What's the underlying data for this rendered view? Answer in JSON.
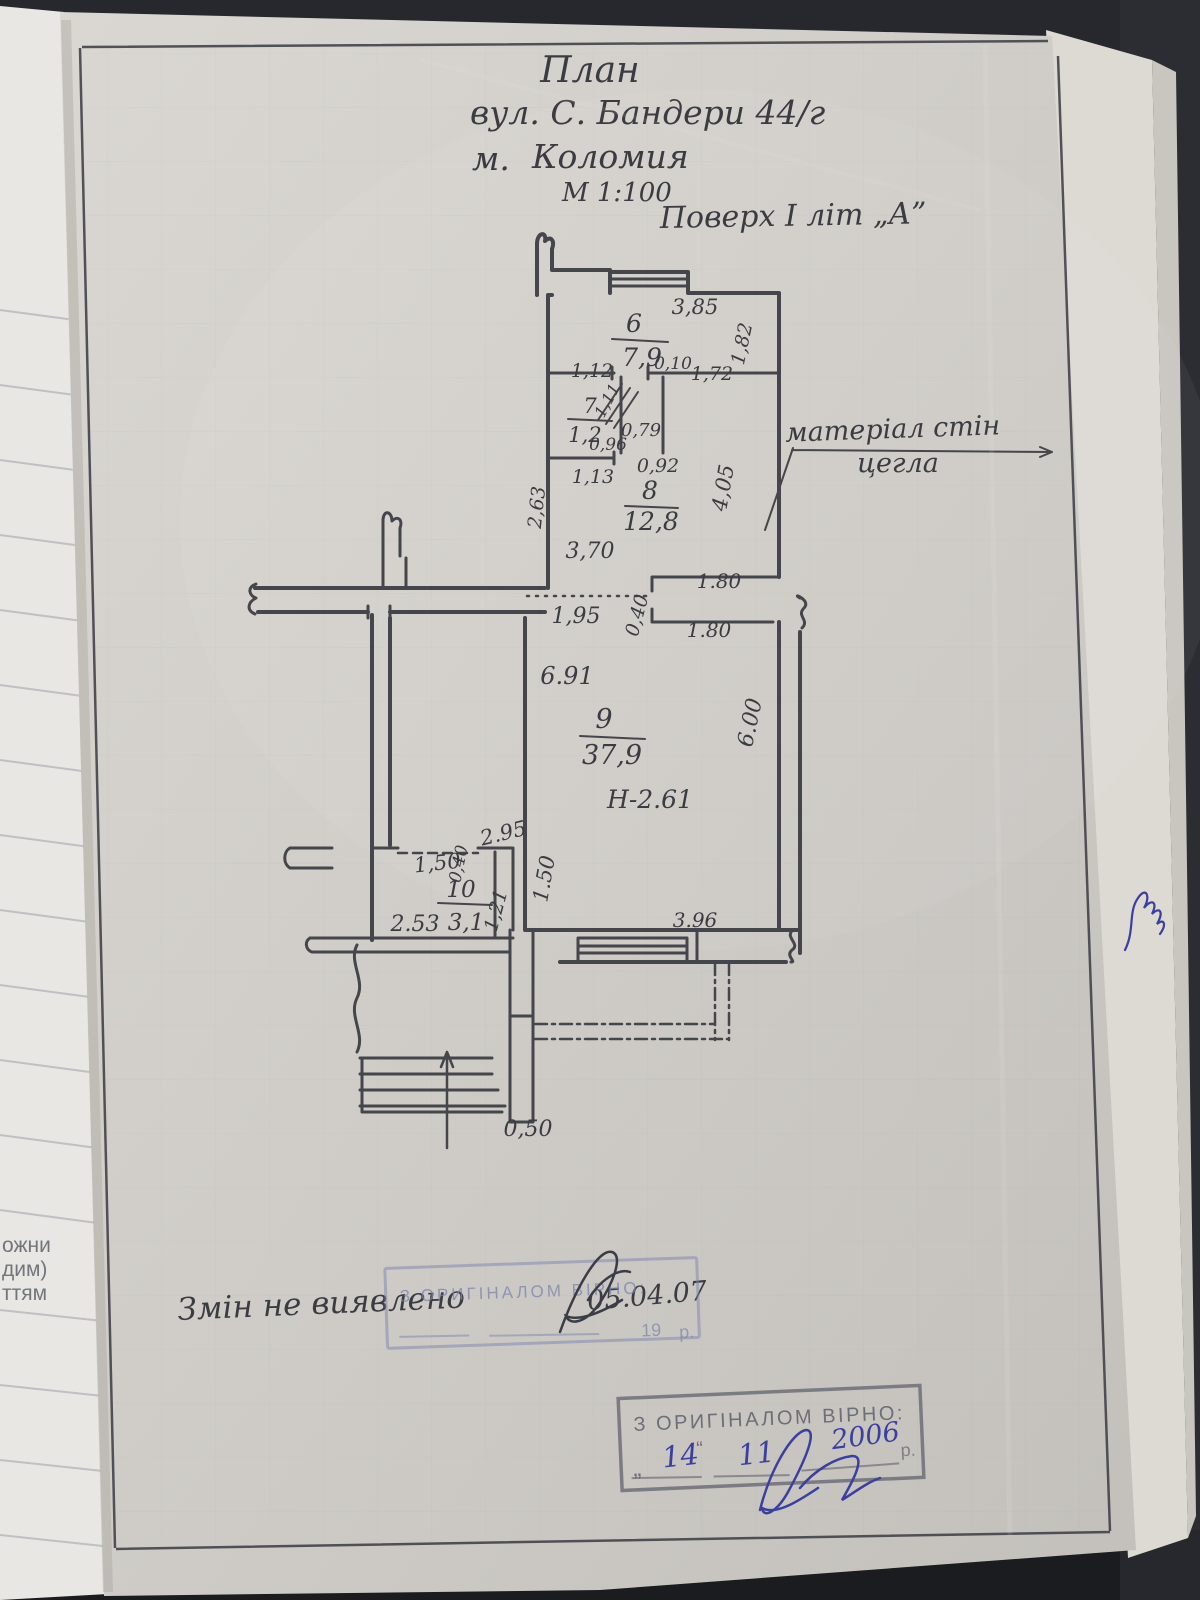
{
  "colors": {
    "desk": "#26282d",
    "paper": "#d2cfca",
    "under_paper": "#e9e7e3",
    "ink": "#3a3c42",
    "pencil_line": "#44464c",
    "blue_ink": "#3b3f9e",
    "stamp_faded_blue": "#7b83ae",
    "stamp_gray": "#6d6f78"
  },
  "title_block": {
    "title": "План",
    "address": "вул. С. Бандери 44/г",
    "city_prefix": "м.",
    "city": "Коломия",
    "scale": "М 1:100",
    "floor": "Поверх І літ „А”"
  },
  "wall_note": {
    "line1": "матеріал стін",
    "line2": "цегла"
  },
  "rooms": [
    {
      "number": "6",
      "area": "7,9"
    },
    {
      "number": "7",
      "area": "1,2"
    },
    {
      "number": "8",
      "area": "12,8"
    },
    {
      "number": "9",
      "area": "37,9"
    },
    {
      "number": "10",
      "area": "3,1"
    }
  ],
  "height_note": "Н-2.61",
  "dimensions": {
    "d385": "3,85",
    "d182": "1,82",
    "d010": "0,10",
    "d112": "1,12",
    "d172": "1,72",
    "d111": "1,11",
    "d079": "0,79",
    "d096": "0,96",
    "d092": "0,92",
    "d113": "1,13",
    "d263": "2,63",
    "d370": "3,70",
    "d405": "4,05",
    "d180a": "1.80",
    "d180b": "1.80",
    "d195": "1,95",
    "d040a": "0,40",
    "d691": "6.91",
    "d600": "6.00",
    "d295": "2.95",
    "d150a": "1,50",
    "d040b": "0,40",
    "d121": "1,21",
    "d150b": "1.50",
    "d253": "2.53",
    "d396": "3.96",
    "d050": "0,50"
  },
  "notes": {
    "no_changes": "Змін не виявлено",
    "date": "05.04.07"
  },
  "stamps": {
    "faded": {
      "line1": "З ОРИГІНАЛОМ ВІРНО:",
      "year_prefix": "19",
      "suffix": "р."
    },
    "dated": {
      "line1": "З ОРИГІНАЛОМ ВІРНО:",
      "open_quote": "„",
      "day": "14",
      "close_quote": "“",
      "month": "11",
      "year": "2006",
      "suffix": "р."
    }
  },
  "under_page_fragments": [
    "ожни",
    "дим)",
    "ттям"
  ],
  "symbols": {
    "north_arrow": "entrance-direction-arrow",
    "wall_break_left": "wall-break-squiggle",
    "wall_break_right": "wall-break-squiggle",
    "signature_dark": "ink-signature",
    "signature_blue": "ink-signature",
    "edge_scribble": "ink-scribble"
  }
}
